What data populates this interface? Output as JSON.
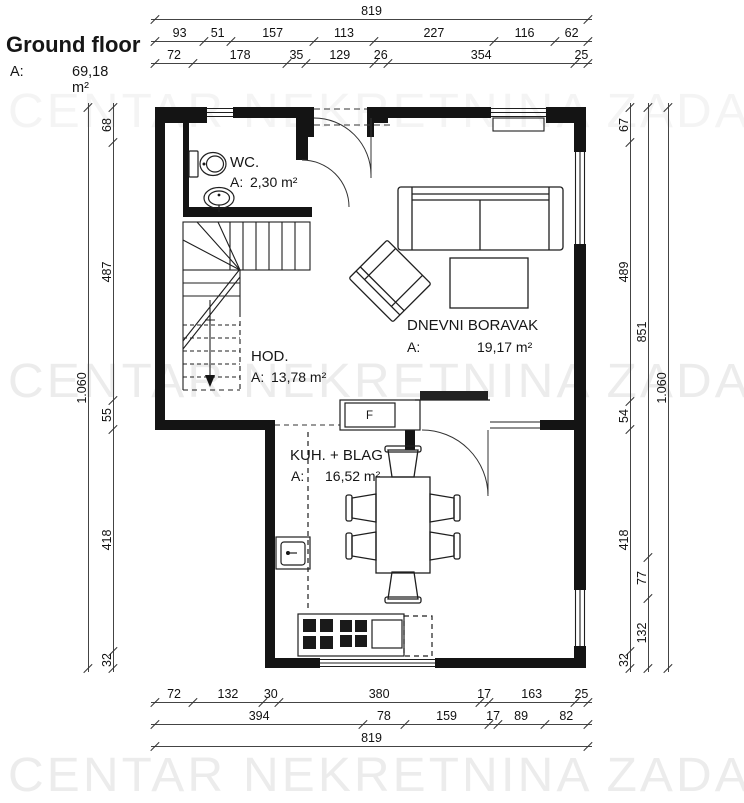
{
  "title": {
    "text": "Ground floor",
    "area_label": "A:",
    "area_value": "69,18 m²"
  },
  "watermark": "CENTAR NEKRETNINA ZADAR",
  "rooms": {
    "wc": {
      "name": "WC.",
      "area_label": "A:",
      "area_value": "2,30 m²"
    },
    "hall": {
      "name": "HOD.",
      "area_label": "A:",
      "area_value": "13,78 m²"
    },
    "living": {
      "name": "DNEVNI BORAVAK",
      "area_label": "A:",
      "area_value": "19,17 m²"
    },
    "kitchen": {
      "name": "KUH. + BLAG",
      "area_label": "A:",
      "area_value": "16,52 m²"
    },
    "fridge_label": "F"
  },
  "dimensions": {
    "top_total": [
      "819"
    ],
    "top_row2": [
      "93",
      "51",
      "157",
      "113",
      "227",
      "116",
      "62"
    ],
    "top_row3": [
      "72",
      "178",
      "35",
      "129",
      "26",
      "354",
      "25"
    ],
    "bottom_row1": [
      "72",
      "132",
      "30",
      "380",
      "17",
      "163",
      "25"
    ],
    "bottom_row2": [
      "394",
      "78",
      "159",
      "17",
      "89",
      "82"
    ],
    "bottom_total": [
      "819"
    ],
    "left_outer": [
      "1.060"
    ],
    "left_inner": [
      "68",
      "487",
      "55",
      "418",
      "32"
    ],
    "right_inner": [
      "67",
      "489",
      "54",
      "418",
      "32"
    ],
    "right_middle": [
      "851",
      "77",
      "132"
    ],
    "right_outer": [
      "1.060"
    ]
  }
}
